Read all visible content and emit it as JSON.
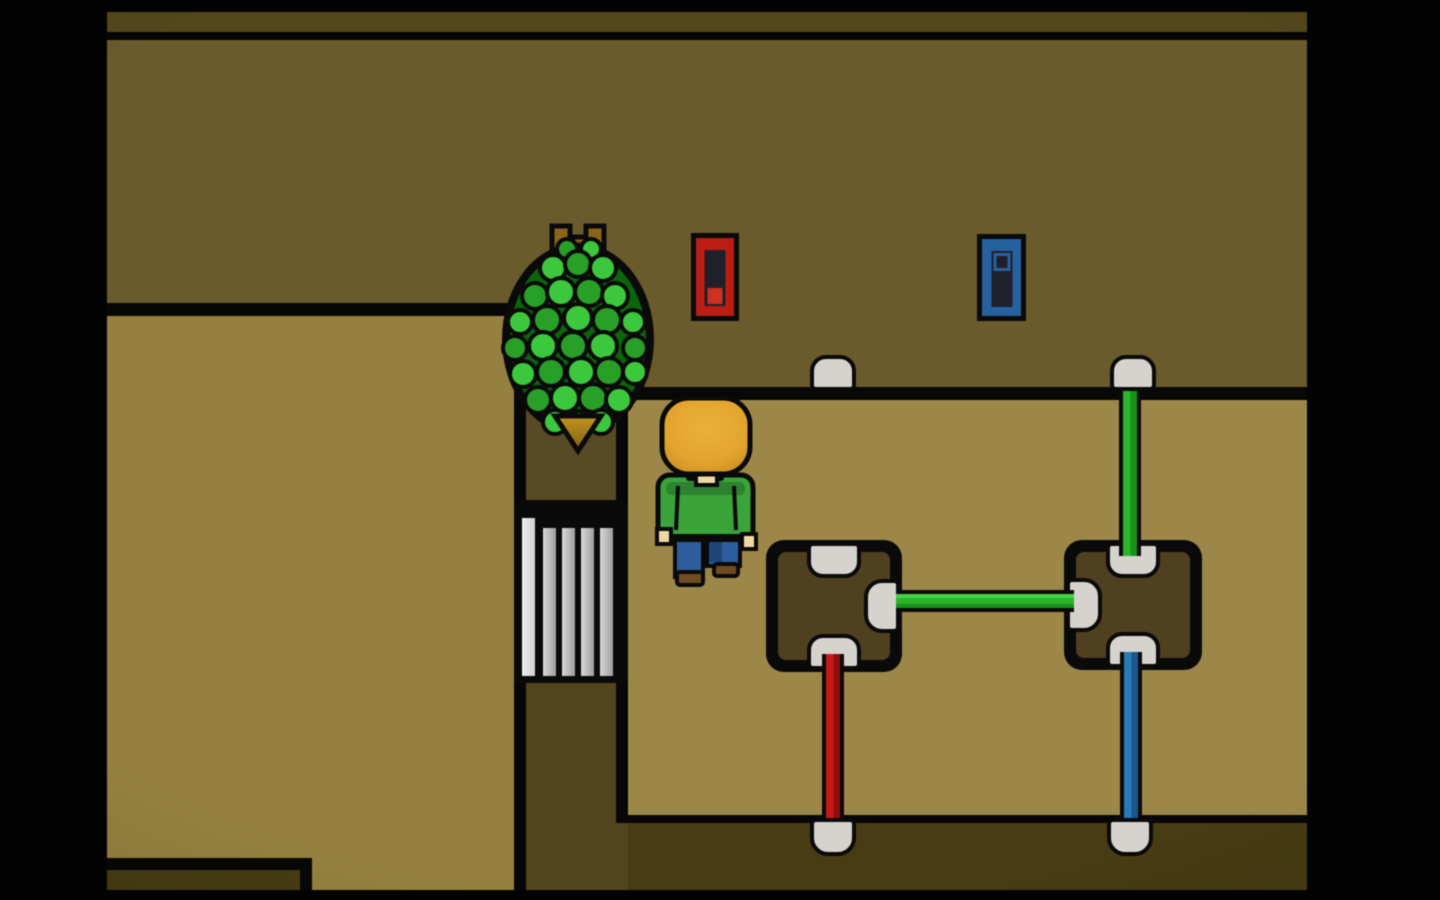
{
  "app": {
    "type": "pixel-art-game",
    "description": "Top-down pixel-art room: a tree over a ladder grate, a player facing a wall with two levers, and a pipe-junction puzzle with colored pipes and sockets"
  },
  "colors": {
    "top-strip": "#53471b",
    "bottom-strip": "#473c13",
    "wall": "#6a5b2d",
    "floor": "#9d8748",
    "floor-left": "#95803f",
    "column-upper": "#584a24",
    "column-lower": "#52451b",
    "box": "#4f4020",
    "port": "#d6d2ce",
    "pipe-green": "#2ab42a",
    "pipe-green-dark": "#179117",
    "pipe-red": "#c81717",
    "pipe-red-dark": "#8f0f0f",
    "pipe-blue": "#2a7ab8",
    "pipe-blue-dark": "#1a578e",
    "lever-red": "#bb1d12",
    "lever-blue": "#25619e",
    "slot": "#20202a",
    "knob-red": "#d03020",
    "leaf-dark": "#0b660b",
    "leaf-mid": "#28a028",
    "leaf-light": "#3cc83c",
    "crown": "#8a6418",
    "crown-dark": "#5e440e",
    "gold": "#c39420",
    "gold-dark": "#7e5f0e",
    "skin-hair": "#e2a42c",
    "skin": "#eed9a2",
    "shirt": "#3aa33a",
    "shirt-dark": "#2d8130",
    "pants": "#2d5d9d",
    "pants-dark": "#1f4679",
    "shoe": "#6f4d20"
  },
  "scene": {
    "player": {
      "id": "player-character",
      "facing": "up",
      "hair": "blond",
      "shirt": "green",
      "pants": "blue",
      "shoes": "brown"
    },
    "levers": [
      {
        "id": "lever-red",
        "color_name": "red",
        "handle_position": "down"
      },
      {
        "id": "lever-blue",
        "color_name": "blue",
        "handle_position": "up"
      }
    ],
    "junction_boxes": [
      {
        "id": "junction-box-left",
        "ports": {
          "top": "empty",
          "right": "green-pipe",
          "bottom": "red-pipe"
        }
      },
      {
        "id": "junction-box-right",
        "ports": {
          "left": "green-pipe",
          "top": "green-pipe",
          "bottom": "blue-pipe"
        }
      }
    ],
    "pipes": [
      {
        "id": "pipe-green-horizontal",
        "color_name": "green",
        "from": "junction-box-left.right",
        "to": "junction-box-right.left"
      },
      {
        "id": "pipe-green-vertical",
        "color_name": "green",
        "from": "junction-box-right.top",
        "to": "wall-socket-right"
      },
      {
        "id": "pipe-red-vertical",
        "color_name": "red",
        "from": "junction-box-left.bottom",
        "to": "lower-socket-left"
      },
      {
        "id": "pipe-blue-vertical",
        "color_name": "blue",
        "from": "junction-box-right.bottom",
        "to": "lower-socket-right"
      }
    ],
    "sockets": [
      {
        "id": "wall-socket-left",
        "state": "empty"
      },
      {
        "id": "wall-socket-right",
        "state": "connected-green"
      },
      {
        "id": "lower-socket-left",
        "state": "connected-red"
      },
      {
        "id": "lower-socket-right",
        "state": "connected-blue"
      }
    ],
    "props": [
      {
        "id": "tree",
        "kind": "round leafy tree with turret-shaped brown top"
      },
      {
        "id": "ladder-grate",
        "kind": "vertical white bars in dark shaft"
      }
    ]
  }
}
